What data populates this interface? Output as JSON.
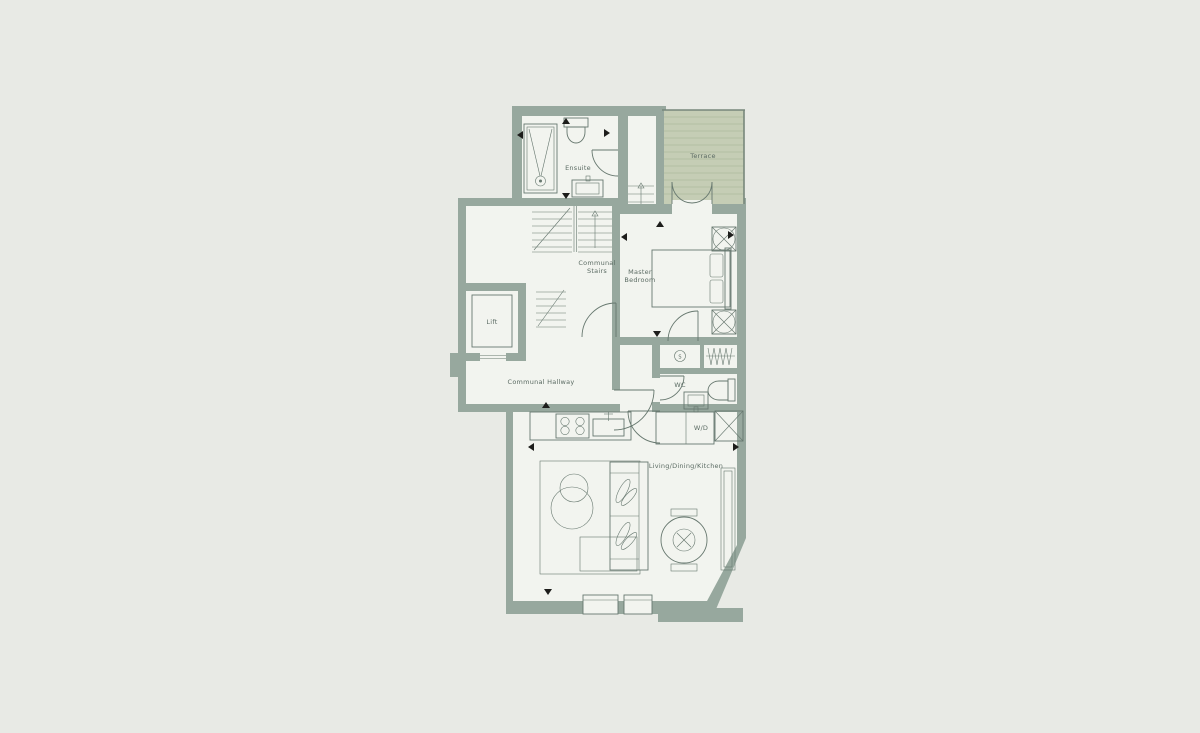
{
  "plan": {
    "type": "apartment-floor-plan",
    "labels": {
      "ensuite": "Ensuite",
      "communal_stairs_line1": "Communal",
      "communal_stairs_line2": "Stairs",
      "lift": "Lift",
      "communal_hallway": "Communal Hallway",
      "master_bedroom_line1": "Master",
      "master_bedroom_line2": "Bedroom",
      "wc": "WC",
      "washer_dryer": "W/D",
      "living_dining_kitchen": "Living/Dining/Kitchen",
      "terrace": "Terrace",
      "storage_cupboard": "S"
    },
    "colors": {
      "background": "#e8eae5",
      "wall": "#97a89e",
      "floor": "#f2f4ef",
      "terrace_fill": "#c5cdb5",
      "terrace_stripe": "#aeb99f",
      "line": "#67786f",
      "text": "#5b6b63",
      "marker": "#1d1d1b"
    },
    "fixtures": [
      "shower",
      "toilet",
      "basin",
      "bath-sink",
      "bed",
      "wardrobe-unit",
      "radiator-coil",
      "storage-cupboard",
      "hob",
      "kitchen-sink",
      "washer-dryer",
      "sofa",
      "armchair",
      "rug",
      "coffee-table",
      "dining-table",
      "dining-chair",
      "sideboard",
      "lift-car",
      "stair-flight",
      "french-doors",
      "window"
    ]
  }
}
